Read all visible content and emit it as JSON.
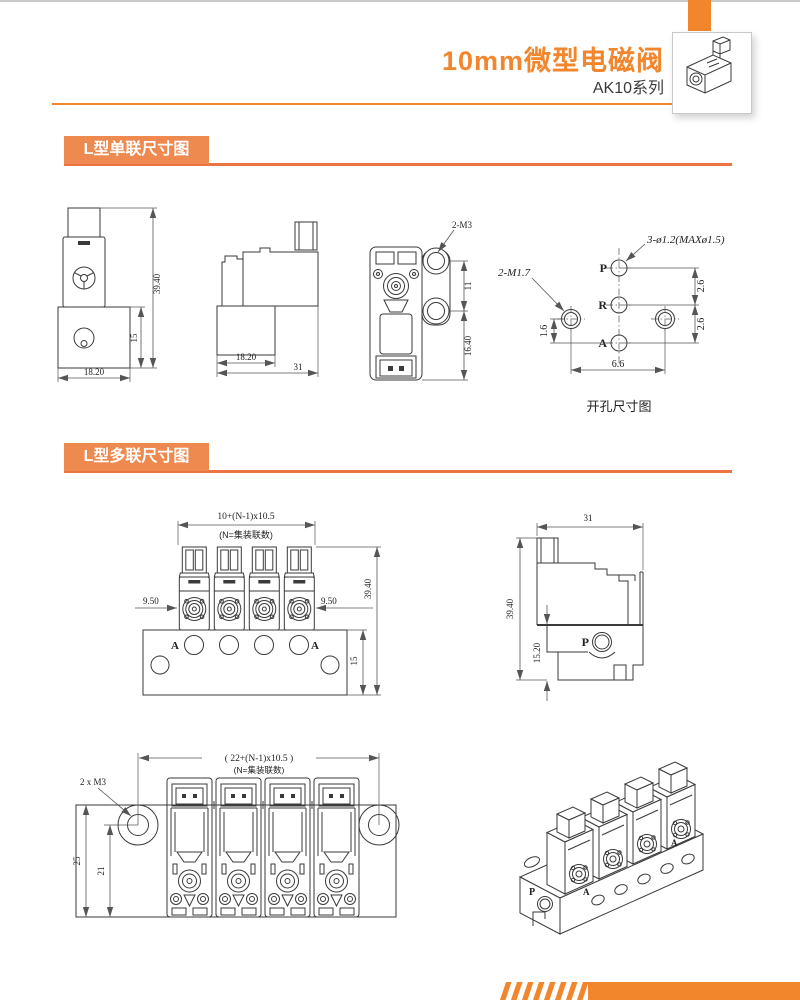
{
  "header": {
    "title": "10mm微型电磁阀",
    "series": "AK10系列"
  },
  "sections": {
    "single_label": "L型单联尺寸图",
    "multi_label": "L型多联尺寸图"
  },
  "single_front": {
    "height": "39.40",
    "base_height": "15",
    "width": "18.20"
  },
  "single_side": {
    "base_width": "18.20",
    "total_width": "31"
  },
  "single_top": {
    "screw_label": "2-M3",
    "hole_pitch": "11",
    "lower_len": "16.40"
  },
  "hole_pattern": {
    "caption": "开孔尺寸图",
    "port_label": "3-ø1.2(MAXø1.5)",
    "screw_label": "2-M1.7",
    "port_p": "P",
    "port_r": "R",
    "port_a": "A",
    "dim_p_r": "2.6",
    "dim_r_a": "2.6",
    "dim_screw_a": "1.6",
    "dim_screw_pitch": "6.6"
  },
  "manifold_front": {
    "pitch_formula": "10+(N-1)x10.5",
    "pitch_note": "(N=集装联数)",
    "dim_left": "9.50",
    "dim_right": "9.50",
    "height": "39.40",
    "base_height": "15",
    "port_a_left": "A",
    "port_a_right": "A"
  },
  "manifold_side": {
    "width": "31",
    "height": "39.40",
    "base_height": "15.20",
    "port_p": "P"
  },
  "manifold_top": {
    "pitch_formula": "( 22+(N-1)x10.5 )",
    "pitch_note": "(N=集装联数)",
    "screw_label": "2 x M3",
    "depth": "25",
    "hole_offset": "21"
  },
  "isometric": {
    "port_p": "P",
    "port_a_front": "A",
    "port_a_side": "A"
  },
  "colors": {
    "accent": "#F1862D",
    "badge": "#EE8A50",
    "line": "#3a3a3a"
  }
}
